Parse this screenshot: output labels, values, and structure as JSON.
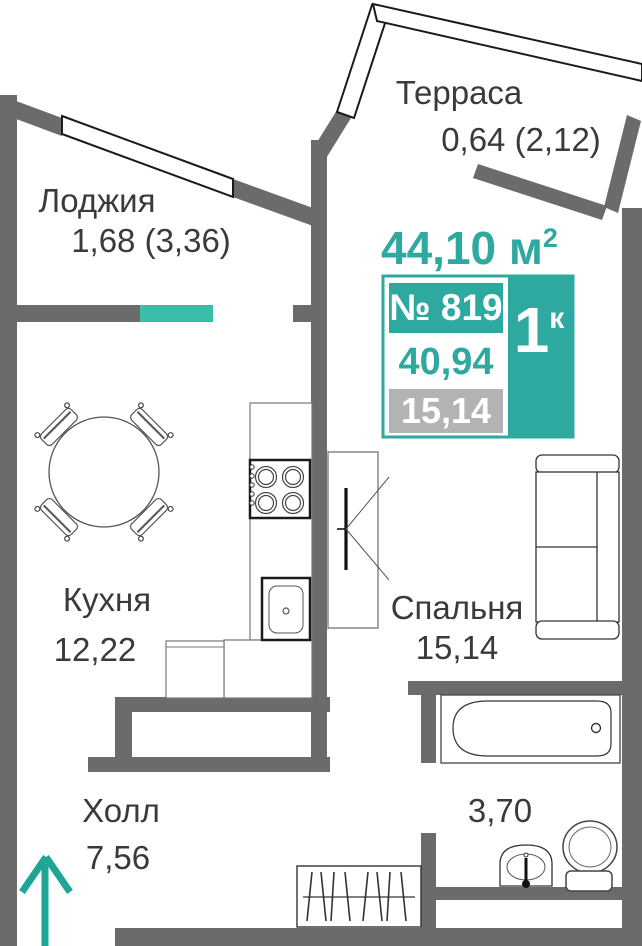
{
  "apartment": {
    "total_area": "44,10 м",
    "total_area_sup": "2",
    "number": "№ 819",
    "rooms_count": "1",
    "rooms_count_sup": "к",
    "living_area": "40,94",
    "room_area": "15,14"
  },
  "rooms": {
    "terrace": {
      "name": "Терраса",
      "area": "0,64 (2,12)"
    },
    "loggia": {
      "name": "Лоджия",
      "area": "1,68 (3,36)"
    },
    "kitchen": {
      "name": "Кухня",
      "area": "12,22"
    },
    "bedroom": {
      "name": "Спальня",
      "area": "15,14"
    },
    "hall": {
      "name": "Холл",
      "area": "7,56"
    },
    "bathroom": {
      "area": "3,70"
    }
  },
  "colors": {
    "accent": "#2ea9a0",
    "accent_light": "#3cbcab",
    "wall": "#6b6b6b",
    "muted_gray": "#b3b3b3",
    "label": "#3a3a3a"
  }
}
